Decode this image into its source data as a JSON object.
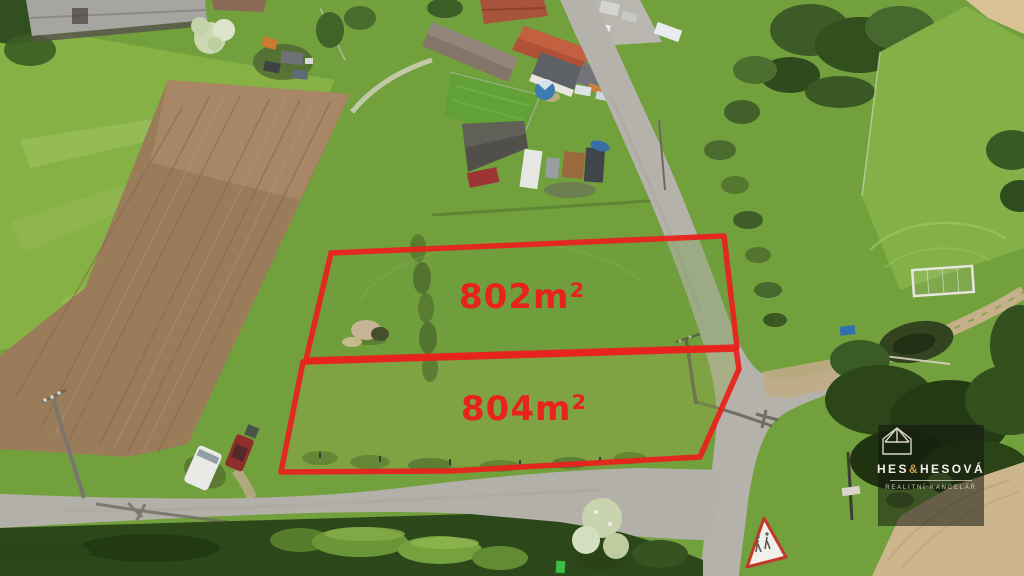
{
  "colors": {
    "annotation_red": "#e8231d",
    "logo_gold": "#c8a04b",
    "logo_text": "#f2efe8"
  },
  "icons": {
    "watermark_icon": "house-roof-icon"
  },
  "annotations": {
    "parcels": [
      {
        "label": "802m²",
        "points": "331,253 724,236 737,347 306,360"
      },
      {
        "label": "804m²",
        "points": "303,362 736,349 739,369 700,457 450,471 281,472"
      }
    ]
  },
  "watermark": {
    "brand_left": "HES",
    "brand_amp": "&",
    "brand_right": "HESOVÁ",
    "tagline": "REALITNÍ KANCELÁŘ"
  }
}
